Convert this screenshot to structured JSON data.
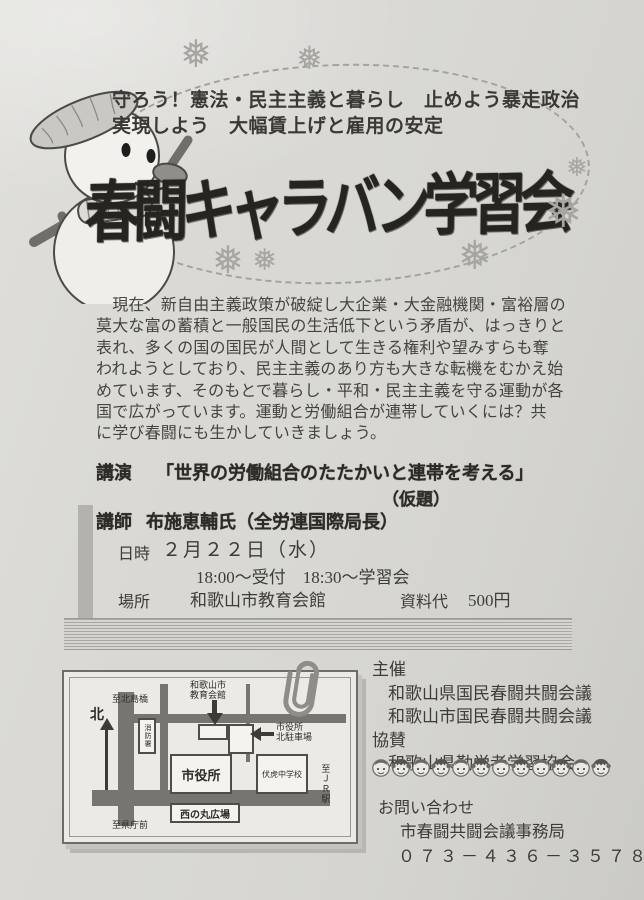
{
  "header": {
    "slogan_line1": "守ろう！憲法・民主主義と暮らし　止めよう暴走政治",
    "slogan_line2": "実現しよう　大幅賃上げと雇用の安定",
    "title": "春闘キャラバン学習会"
  },
  "intro": {
    "lines": [
      "　現在、新自由主義政策が破綻し大企業・大金融機関・富裕層の",
      "莫大な富の蓄積と一般国民の生活低下という矛盾が、はっきりと",
      "表れ、多くの国の国民が人間として生きる権利や望みすらも奪",
      "われようとしており、民主主義のあり方も大きな転機をむかえ始",
      "めています、そのもとで暮らし・平和・民主主義を守る運動が各",
      "国で広がっています。運動と労働組合が連帯していくには？共",
      "に学び春闘にも生かしていきましょう。"
    ]
  },
  "event": {
    "lecture_label": "講演",
    "lecture_title": "「世界の労働組合のたたかいと連帯を考える」",
    "lecture_subtitle": "（仮題）",
    "lecturer_label": "講師",
    "lecturer": "布施恵輔氏（全労連国際局長）",
    "datetime_label": "日時",
    "date": "２月２２日（水）",
    "time": "18:00～受付　18:30～学習会",
    "place_label": "場所",
    "place": "和歌山市教育会館",
    "fee_label": "資料代",
    "fee": "500円"
  },
  "map": {
    "to_kitajima": "至北島橋",
    "north": "北",
    "edu_label1": "和歌山市",
    "edu_label2": "教育会館",
    "fire_station": "消防署",
    "parking_label1": "市役所",
    "parking_label2": "北駐車場",
    "city_hall": "市役所",
    "school": "伏虎中学校",
    "plaza": "西の丸広場",
    "to_kencho": "至県庁前",
    "to_jr": "至ＪＲ駅"
  },
  "organizers": {
    "host_label": "主催",
    "hosts": [
      "和歌山県国民春闘共闘会議",
      "和歌山市国民春闘共闘会議"
    ],
    "support_label": "協賛",
    "supporters": [
      "和歌山県勤労者学習協会"
    ]
  },
  "contact": {
    "label": "お問い合わせ",
    "office": "市春闘共闘会議事務局",
    "phone": "０７３－４３６－３５７８"
  },
  "decor": {
    "snowflake": "❅",
    "faces_count": 12
  },
  "colors": {
    "paper": "#d8d7d3",
    "ink": "#25241f",
    "body_text": "#45443f",
    "road": "#76756f",
    "artifact": "#b3b2ae"
  }
}
